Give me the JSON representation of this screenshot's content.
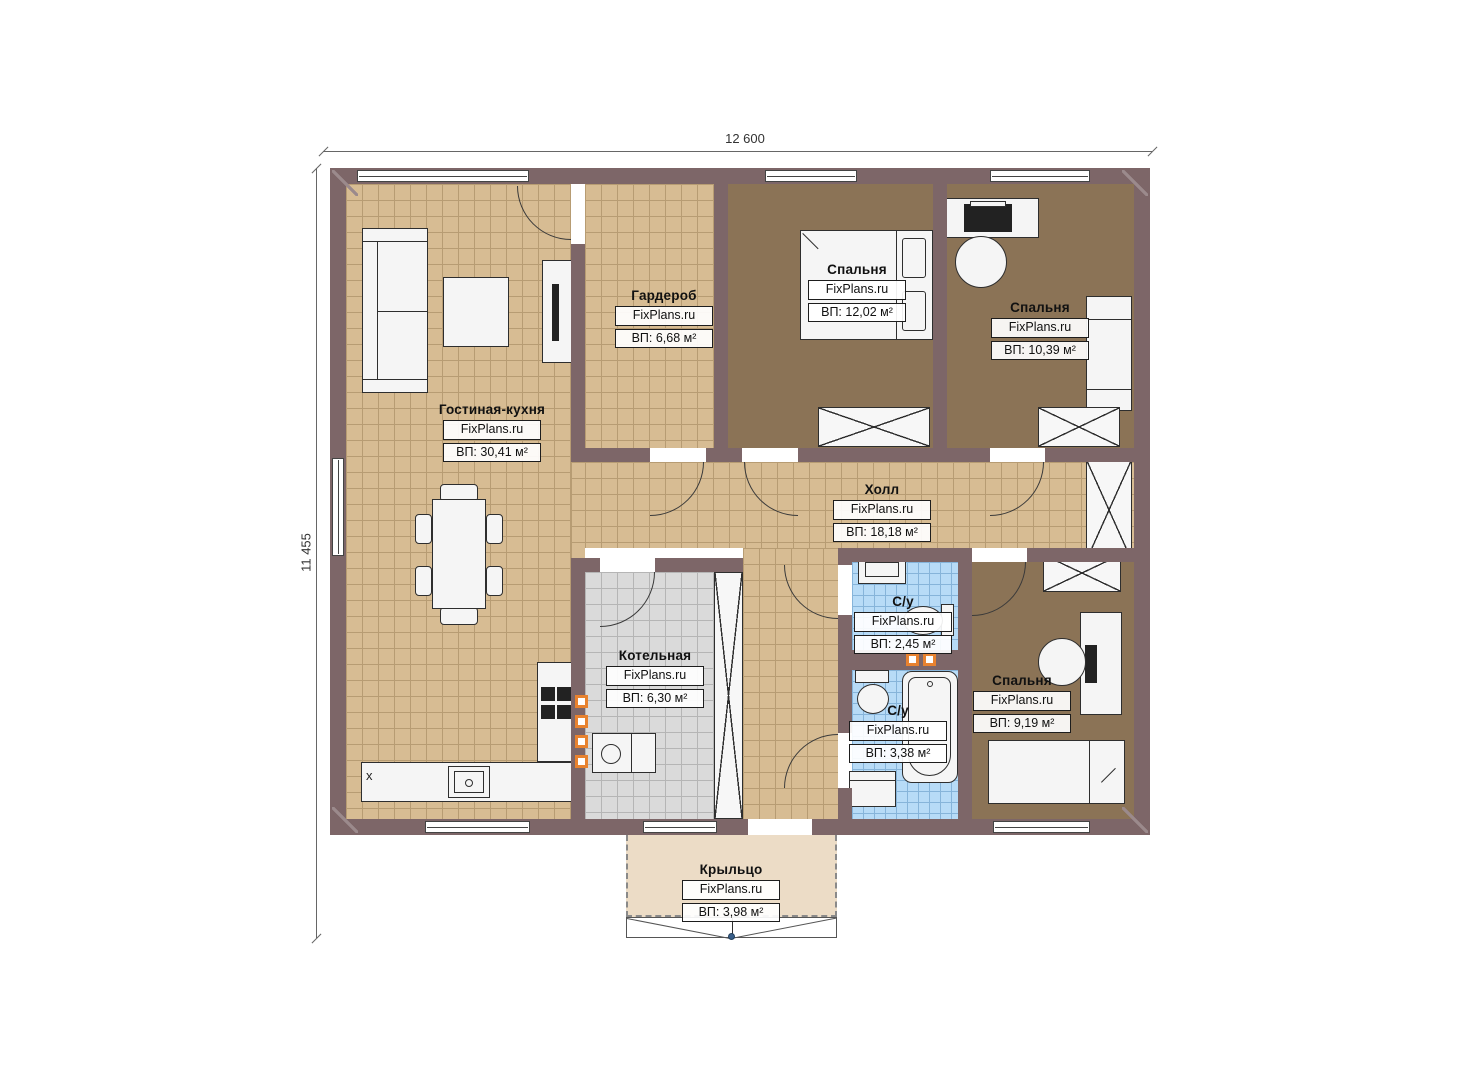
{
  "dimensions": {
    "width_label": "12 600",
    "height_label": "11 455"
  },
  "watermark": "FixPlans.ru",
  "rooms": [
    {
      "id": "living-kitchen",
      "name": "Гостиная-кухня",
      "watermark": "FixPlans.ru",
      "area": "ВП: 30,41 м²"
    },
    {
      "id": "wardrobe",
      "name": "Гардероб",
      "watermark": "FixPlans.ru",
      "area": "ВП: 6,68 м²"
    },
    {
      "id": "bedroom-1",
      "name": "Спальня",
      "watermark": "FixPlans.ru",
      "area": "ВП: 12,02 м²"
    },
    {
      "id": "bedroom-2",
      "name": "Спальня",
      "watermark": "FixPlans.ru",
      "area": "ВП: 10,39 м²"
    },
    {
      "id": "hall",
      "name": "Холл",
      "watermark": "FixPlans.ru",
      "area": "ВП: 18,18 м²"
    },
    {
      "id": "boiler-room",
      "name": "Котельная",
      "watermark": "FixPlans.ru",
      "area": "ВП: 6,30 м²"
    },
    {
      "id": "bathroom-1",
      "name": "С/у",
      "watermark": "FixPlans.ru",
      "area": "ВП: 2,45 м²"
    },
    {
      "id": "bathroom-2",
      "name": "С/у",
      "watermark": "FixPlans.ru",
      "area": "ВП: 3,38 м²"
    },
    {
      "id": "bedroom-3",
      "name": "Спальня",
      "watermark": "FixPlans.ru",
      "area": "ВП: 9,19 м²"
    },
    {
      "id": "porch",
      "name": "Крыльцо",
      "watermark": "FixPlans.ru",
      "area": "ВП: 3,98 м²"
    }
  ],
  "markers": {
    "kitchen_x": "x"
  },
  "colors": {
    "wall": "#7d6668",
    "floor_tile": "#d7bc93",
    "floor_bedroom": "#8b7356",
    "floor_bathroom": "#b7dbf7",
    "floor_boiler": "#dadada",
    "floor_porch": "#ecdcc6",
    "vent_accent": "#e8822f"
  }
}
